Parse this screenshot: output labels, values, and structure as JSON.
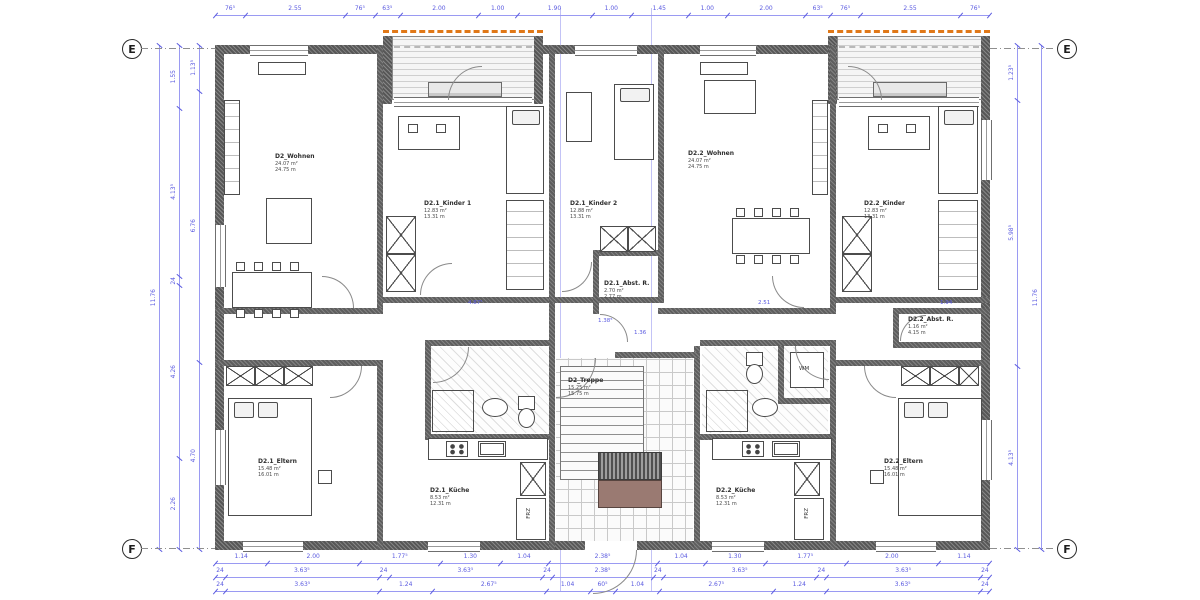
{
  "drawing": {
    "grid_markers": {
      "top_row": "E",
      "bottom_row": "F"
    },
    "rooms": {
      "wohnen1": {
        "name": "D2_Wohnen",
        "area": "24.07 m²",
        "perimeter": "24.75 m"
      },
      "kinder1": {
        "name": "D2.1_Kinder 1",
        "area": "12.83 m²",
        "perimeter": "13.31 m"
      },
      "kinder2": {
        "name": "D2.1_Kinder 2",
        "area": "12.88 m²",
        "perimeter": "13.31 m"
      },
      "wohnen2": {
        "name": "D2.2_Wohnen",
        "area": "24.07 m²",
        "perimeter": "24.75 m"
      },
      "kinder3": {
        "name": "D2.2_Kinder",
        "area": "12.83 m²",
        "perimeter": "13.31 m"
      },
      "abst1": {
        "name": "D2.1_Abst. R.",
        "area": "2.70 m²",
        "perimeter": "2.77 m"
      },
      "abst2": {
        "name": "D2.2_Abst. R.",
        "area": "1.16 m²",
        "perimeter": "4.15 m"
      },
      "treppe": {
        "name": "D2_Treppe",
        "area": "15.25 m²",
        "perimeter": "15.75 m"
      },
      "eltern1": {
        "name": "D2.1_Eltern",
        "area": "15.48 m²",
        "perimeter": "16.01 m"
      },
      "kueche1": {
        "name": "D2.1_Küche",
        "area": "8.53 m²",
        "perimeter": "12.31 m"
      },
      "kueche2": {
        "name": "D2.2_Küche",
        "area": "8.53 m²",
        "perimeter": "12.31 m"
      },
      "eltern2": {
        "name": "D2.2_Eltern",
        "area": "15.48 m²",
        "perimeter": "16.01 m"
      }
    },
    "appliance_labels": {
      "wm": "WM",
      "frz1": "FRZ",
      "frz2": "FRZ"
    },
    "inline_dims": {
      "d1": "4.87⁵",
      "d2": "1.38⁵",
      "d3": "1.36",
      "d4": "2.51",
      "d5": "1.94"
    },
    "dimensions": {
      "top": [
        "76⁵",
        "2.55",
        "76⁵",
        "63⁵",
        "2.00",
        "1.00",
        "1.90",
        "1.00",
        "1.45",
        "1.00",
        "2.00",
        "63⁵",
        "76⁵",
        "2.55",
        "76⁵"
      ],
      "bottom_row1": [
        "1.14",
        "2.00",
        "1.77⁵",
        "1.30",
        "1.04",
        "2.38⁵",
        "1.04",
        "1.30",
        "1.77⁵",
        "2.00",
        "1.14"
      ],
      "bottom_row2": [
        "24",
        "3.63⁵",
        "24",
        "3.63⁵",
        "24",
        "2.38⁵",
        "24",
        "3.63⁵",
        "24",
        "3.63⁵",
        "24"
      ],
      "bottom_row3": [
        "24",
        "3.63⁵",
        "1.24",
        "2.67⁵",
        "1.04",
        "60⁵",
        "1.04",
        "2.67⁵",
        "1.24",
        "3.63⁵",
        "24"
      ],
      "left_outer": [
        "11.76"
      ],
      "left_mid": [
        "1.55",
        "4.13⁵",
        "24",
        "4.26",
        "2.26"
      ],
      "left_inner": [
        "1.13⁵",
        "6.76",
        "4.70"
      ],
      "right_inner": [
        "1.23⁵",
        "5.98⁵",
        "4.13⁵"
      ],
      "right_outer": [
        "11.76"
      ]
    },
    "colors": {
      "dimension": "#5a5ae0",
      "dimension_line": "#9a9af2",
      "wall": "#575757",
      "accent_orange": "#e07818",
      "stair_brown": "#9a7a72"
    }
  }
}
